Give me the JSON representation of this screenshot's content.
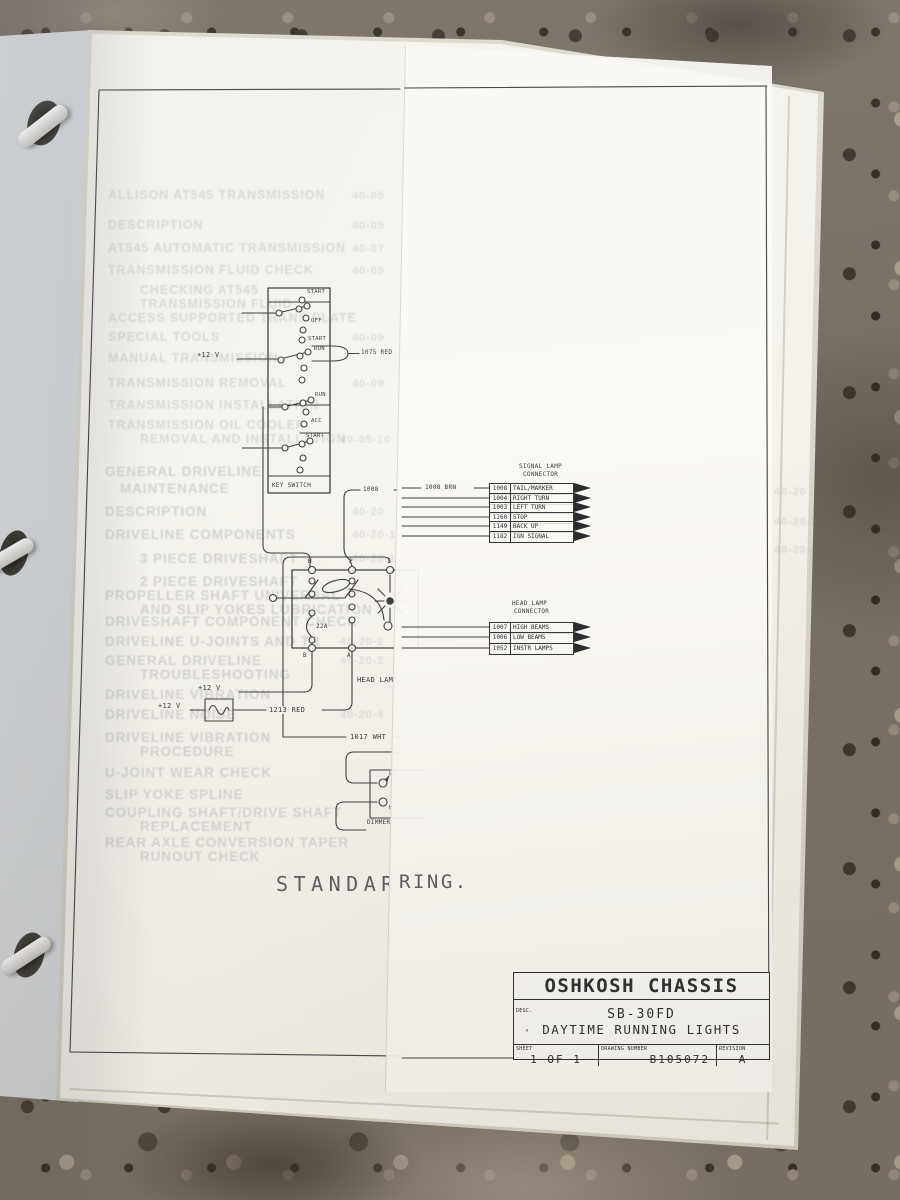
{
  "scene": {
    "counter_base": "#776f64",
    "binder": "#d9dcde",
    "page": "#f6f4ee",
    "overlay_page": "#fbf9f4",
    "ink": "#3a3a3e"
  },
  "big": {
    "left": "STANDAR",
    "right": "RING."
  },
  "wire": {
    "v12": "+12 V",
    "r1075": "1075 RED",
    "n1008": "1008",
    "brn1008": "1008 BRN",
    "red1213": "1213 RED",
    "wht1017": "1017 WHT -",
    "amp": "22A",
    "headlamp": "HEAD LAMP",
    "dimmer": "DIMMER",
    "lo": "LO",
    "hi": "HI"
  },
  "term": {
    "h": "H",
    "p": "P",
    "i": "I",
    "b": "B",
    "a": "A"
  },
  "key": {
    "caption": "KEY SWITCH",
    "p": [
      "START",
      "OFF",
      "START",
      "RUN",
      "RUN",
      "ACC",
      "START"
    ]
  },
  "sig": {
    "t1": "SIGNAL LAMP",
    "t2": "CONNECTOR",
    "c": [
      "1008",
      "1004",
      "1003",
      "1260",
      "1149",
      "1182"
    ],
    "l": [
      "TAIL/MARKER",
      "RIGHT TURN",
      "LEFT TURN",
      "STOP",
      "BACK UP",
      "IGN SIGNAL"
    ]
  },
  "head": {
    "t1": "HEAD LAMP",
    "t2": "CONNECTOR",
    "c": [
      "1007",
      "1006",
      "1052"
    ],
    "l": [
      "HIGH BEAMS",
      "LOW BEAMS",
      "INSTR LAMPS"
    ]
  },
  "tb": {
    "company": "OSHKOSH CHASSIS",
    "desc": "DESC.",
    "model": "SB-30FD",
    "name": "DAYTIME RUNNING LIGHTS",
    "tick": "'",
    "sheet_l": "SHEET",
    "sheet": "1 OF 1",
    "dwg_l": "DRAWING NUMBER",
    "dwg": "B105072",
    "rev_l": "REVISION",
    "rev": "A"
  },
  "bleed": {
    "s1": [
      "ALLISON AT545 TRANSMISSION",
      "DESCRIPTION",
      "AT545 AUTOMATIC TRANSMISSION",
      "TRANSMISSION FLUID CHECK",
      "CHECKING AT545",
      "TRANSMISSION FLUID",
      "ACCESS SUPPORTED TRANS PLATE",
      "SPECIAL TOOLS",
      "MANUAL TRANSMISSION",
      "TRANSMISSION REMOVAL",
      "TRANSMISSION INSTALLATION",
      "TRANSMISSION OIL COOLER",
      "REMOVAL AND INSTALLATION"
    ],
    "s1n": [
      "40-05",
      "40-05",
      "40-07",
      "40-09",
      "40-09",
      "40-09",
      "40-05-10"
    ],
    "s2": [
      "GENERAL DRIVELINE",
      "MAINTENANCE",
      "DESCRIPTION",
      "DRIVELINE COMPONENTS",
      "3 PIECE DRIVESHAFT",
      "2 PIECE DRIVESHAFT",
      "PROPELLER SHAFT UNIVERSAL",
      "AND SLIP YOKES LUBRICATION",
      "DRIVESHAFT COMPONENT CHECK",
      "DRIVELINE U-JOINTS AND TR",
      "GENERAL DRIVELINE",
      "TROUBLESHOOTING",
      "DRIVELINE VIBRATION",
      "DRIVELINE NOISE",
      "DRIVELINE VIBRATION",
      "PROCEDURE",
      "U-JOINT WEAR CHECK",
      "SLIP YOKE SPLINE",
      "COUPLING SHAFT/DRIVE SHAFT",
      "REPLACEMENT",
      "REAR AXLE CONVERSION TAPER",
      "RUNOUT CHECK"
    ],
    "s2n": [
      "40-20",
      "40-20-1",
      "40-20-1",
      "40-20-2",
      "40-20-2",
      "40-20-4"
    ],
    "right": [
      "40-20",
      "40-20-2",
      "40-20-4"
    ]
  }
}
